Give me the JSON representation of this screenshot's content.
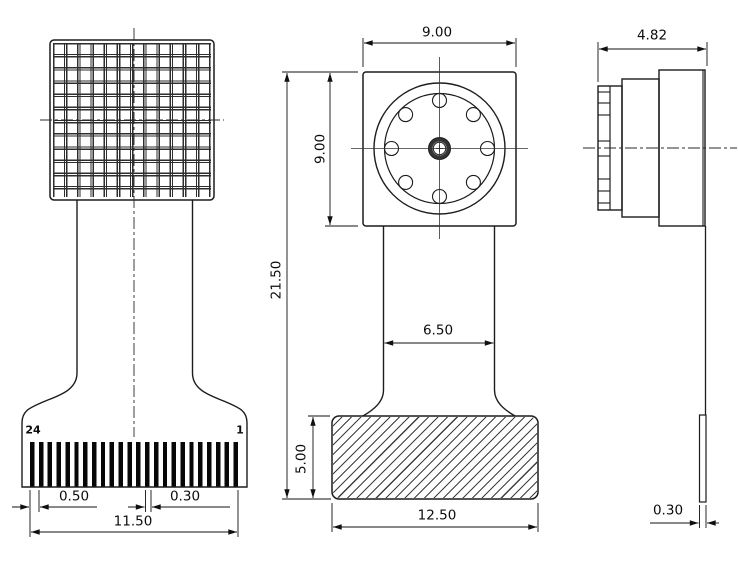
{
  "drawing_type": "engineering-three-view-drawing",
  "component": "camera-module-with-flex-cable",
  "colors": {
    "background": "#ffffff",
    "line": "#1c1c1c"
  },
  "back_view": {
    "pin_label_left": "24",
    "pin_label_right": "1",
    "dim_pin_pitch": "0.50",
    "dim_pin_width": "0.30",
    "dim_connector_width": "11.50"
  },
  "front_view": {
    "dim_module_width": "9.00",
    "dim_module_height": "9.00",
    "dim_total_height": "21.50",
    "dim_flex_width": "6.50",
    "dim_connector_height": "5.00",
    "dim_connector_width": "12.50"
  },
  "side_view": {
    "dim_depth": "4.82",
    "dim_flex_thickness": "0.30"
  }
}
